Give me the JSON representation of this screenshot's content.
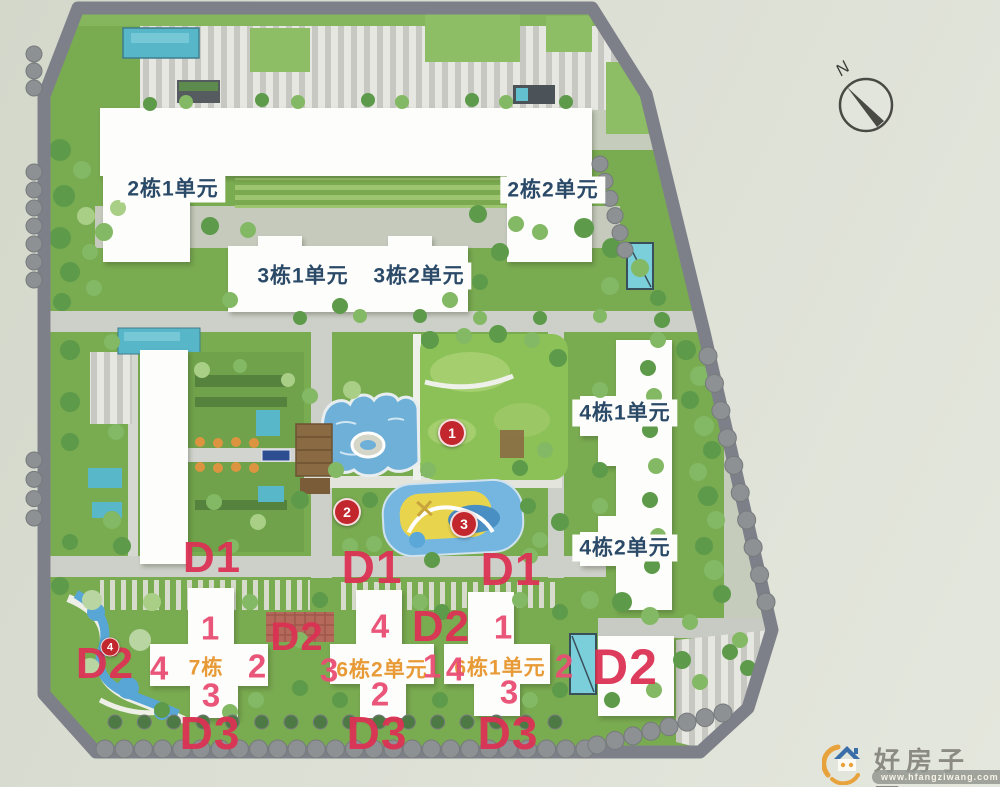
{
  "colors": {
    "background": "#dcdfd4",
    "ring_road": "#7e8089",
    "building_fill": "#fdfdfb",
    "label_blue": "#2b4a68",
    "label_orange": "#e79a36",
    "zone_label_red": "#dd3154",
    "unit_number_pink": "#ea4e74",
    "badge_red": "#c1272d",
    "pool_teal": "#57b6c8",
    "pond_blue": "#6fb0d8",
    "lawn_green": "#79ab51"
  },
  "compass": {
    "north_label": "N"
  },
  "building_labels": [
    {
      "id": "2-1",
      "text": "2栋1单元"
    },
    {
      "id": "2-2",
      "text": "2栋2单元"
    },
    {
      "id": "3-1",
      "text": "3栋1单元"
    },
    {
      "id": "3-2",
      "text": "3栋2单元"
    },
    {
      "id": "4-1",
      "text": "4栋1单元"
    },
    {
      "id": "4-2",
      "text": "4栋2单元"
    }
  ],
  "building_names": [
    {
      "id": "7",
      "text": "7栋"
    },
    {
      "id": "6-2",
      "text": "6栋2单元"
    },
    {
      "id": "6-1",
      "text": "6栋1单元"
    }
  ],
  "zone_labels": [
    {
      "text": "D1"
    },
    {
      "text": "D1"
    },
    {
      "text": "D1"
    },
    {
      "text": "D2"
    },
    {
      "text": "D2"
    },
    {
      "text": "D2"
    },
    {
      "text": "D2"
    },
    {
      "text": "D3"
    },
    {
      "text": "D3"
    },
    {
      "text": "D3"
    }
  ],
  "unit_numbers": [
    {
      "building": "7栋",
      "text": "1"
    },
    {
      "building": "7栋",
      "text": "4"
    },
    {
      "building": "7栋",
      "text": "2"
    },
    {
      "building": "7栋",
      "text": "3"
    },
    {
      "building": "6栋2单元",
      "text": "4"
    },
    {
      "building": "6栋2单元",
      "text": "3"
    },
    {
      "building": "6栋2单元",
      "text": "1"
    },
    {
      "building": "6栋2单元",
      "text": "2"
    },
    {
      "building": "6栋1单元",
      "text": "1"
    },
    {
      "building": "6栋1单元",
      "text": "4"
    },
    {
      "building": "6栋1单元",
      "text": "2"
    },
    {
      "building": "6栋1单元",
      "text": "3"
    }
  ],
  "marker_badges": [
    {
      "text": "1"
    },
    {
      "text": "2"
    },
    {
      "text": "3"
    },
    {
      "text": "4"
    }
  ],
  "watermark": {
    "site_name": "好房子网",
    "url": "www.hfangziwang.com"
  }
}
